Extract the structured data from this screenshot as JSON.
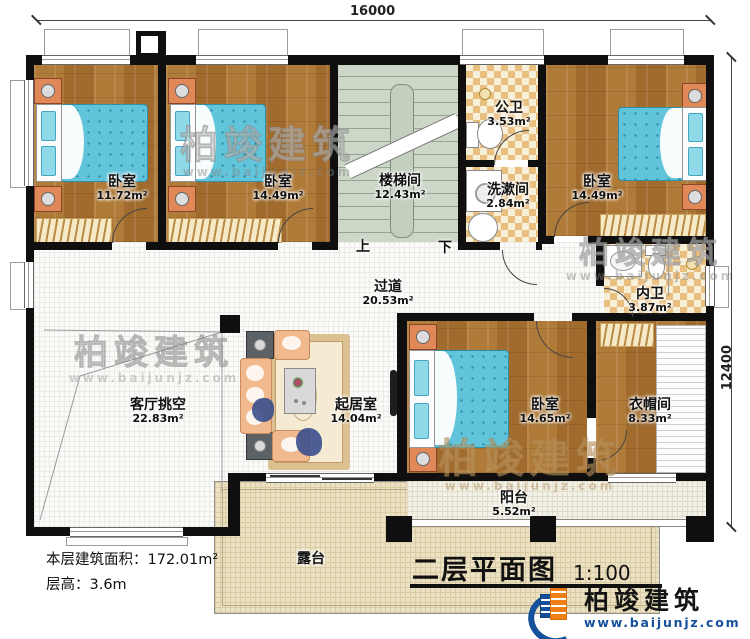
{
  "plan": {
    "title": "二层平面图",
    "scale": "1:100",
    "stats": {
      "floor_area": "本层建筑面积：172.01m²",
      "floor_height": "层高：3.6m"
    },
    "dimensions": {
      "width": "16000",
      "depth": "12400"
    },
    "stair_marks": {
      "up": "上",
      "down": "下"
    },
    "rooms": [
      {
        "name": "卧室",
        "area": "11.72m²"
      },
      {
        "name": "卧室",
        "area": "14.49m²"
      },
      {
        "name": "楼梯间",
        "area": "12.43m²"
      },
      {
        "name": "公卫",
        "area": "3.53m²"
      },
      {
        "name": "洗漱间",
        "area": "2.84m²"
      },
      {
        "name": "卧室",
        "area": "14.49m²"
      },
      {
        "name": "内卫",
        "area": "3.87m²"
      },
      {
        "name": "过道",
        "area": "20.53m²"
      },
      {
        "name": "客厅挑空",
        "area": "22.83m²"
      },
      {
        "name": "起居室",
        "area": "14.04m²"
      },
      {
        "name": "卧室",
        "area": "14.65m²"
      },
      {
        "name": "衣帽间",
        "area": "8.33m²"
      },
      {
        "name": "阳台",
        "area": "5.52m²"
      },
      {
        "name": "露台",
        "area": ""
      }
    ]
  },
  "brand": {
    "name": "柏竣建筑",
    "url": "www.baijunjz.com"
  }
}
